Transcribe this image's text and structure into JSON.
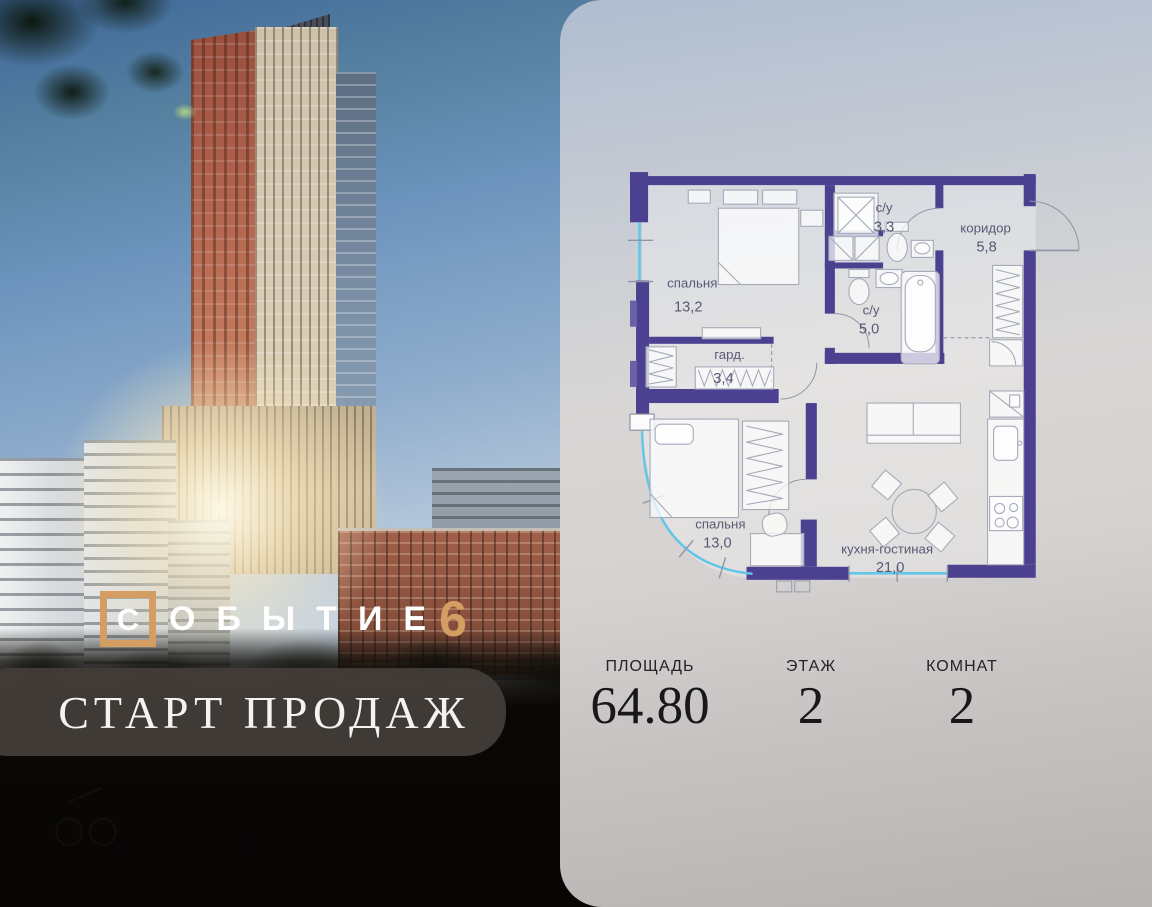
{
  "logo": {
    "boxed_letter": "С",
    "word_rest": "ОБЫТИЕ",
    "number": "6"
  },
  "banner": {
    "text": "СТАРТ ПРОДАЖ"
  },
  "floorplan": {
    "rooms": [
      {
        "name": "спальня",
        "area": "13,2"
      },
      {
        "name": "с/у",
        "area": "3,3"
      },
      {
        "name": "коридор",
        "area": "5,8"
      },
      {
        "name": "с/у",
        "area": "5,0"
      },
      {
        "name": "гард.",
        "area": "3,4"
      },
      {
        "name": "спальня",
        "area": "13,0"
      },
      {
        "name": "кухня-гостиная",
        "area": "21,0"
      }
    ]
  },
  "stats": [
    {
      "label": "ПЛОЩАДЬ",
      "value": "64.80"
    },
    {
      "label": "ЭТАЖ",
      "value": "2"
    },
    {
      "label": "КОМНАТ",
      "value": "2"
    }
  ],
  "colors": {
    "wall": "#4c4190",
    "window": "#62c6e8",
    "accent": "#d49e62",
    "banner_bg": "#423c37"
  }
}
